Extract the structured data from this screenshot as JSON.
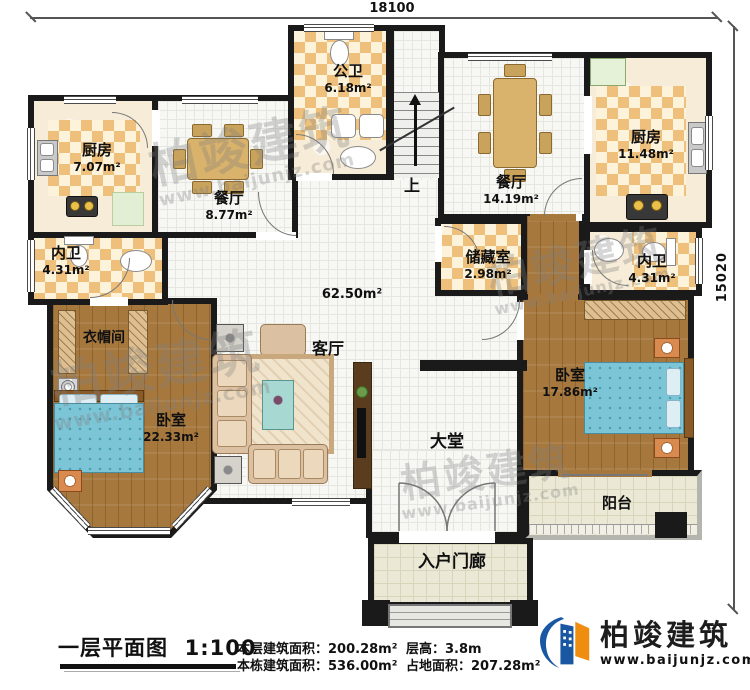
{
  "dimensions": {
    "top": "18100",
    "right": "15020"
  },
  "rooms": {
    "kitchen_left": {
      "name": "厨房",
      "area": "7.07m²"
    },
    "dining_left": {
      "name": "餐厅",
      "area": "8.77m²"
    },
    "public_bath": {
      "name": "公卫",
      "area": "6.18m²"
    },
    "stairs": {
      "label": "上"
    },
    "dining_right": {
      "name": "餐厅",
      "area": "14.19m²"
    },
    "kitchen_right": {
      "name": "厨房",
      "area": "11.48m²"
    },
    "inner_bath_left": {
      "name": "内卫",
      "area": "4.31m²"
    },
    "storage": {
      "name": "储藏室",
      "area": "2.98m²"
    },
    "inner_bath_right": {
      "name": "内卫",
      "area": "4.31m²"
    },
    "cloakroom": {
      "name": "衣帽间"
    },
    "living_room": {
      "name": "客厅",
      "area": "62.50m²"
    },
    "bedroom_left": {
      "name": "卧室",
      "area": "22.33m²"
    },
    "bedroom_right": {
      "name": "卧室",
      "area": "17.86m²"
    },
    "hall": {
      "name": "大堂"
    },
    "balcony": {
      "name": "阳台"
    },
    "porch": {
      "name": "入户门廊"
    }
  },
  "watermark": {
    "brand": "柏竣建筑",
    "url": "www.baijunjz.com"
  },
  "footer": {
    "plan_title": "一层平面图",
    "plan_scale": "1:100",
    "stats": [
      {
        "label": "本层建筑面积：",
        "value": "200.28m²"
      },
      {
        "label": "本栋建筑面积：",
        "value": "536.00m²"
      },
      {
        "label": "层高：",
        "value": "3.8m"
      },
      {
        "label": "占地面积：",
        "value": "207.28m²"
      }
    ],
    "logo": {
      "brand": "柏竣建筑",
      "url": "www.baijunjz.com"
    }
  }
}
